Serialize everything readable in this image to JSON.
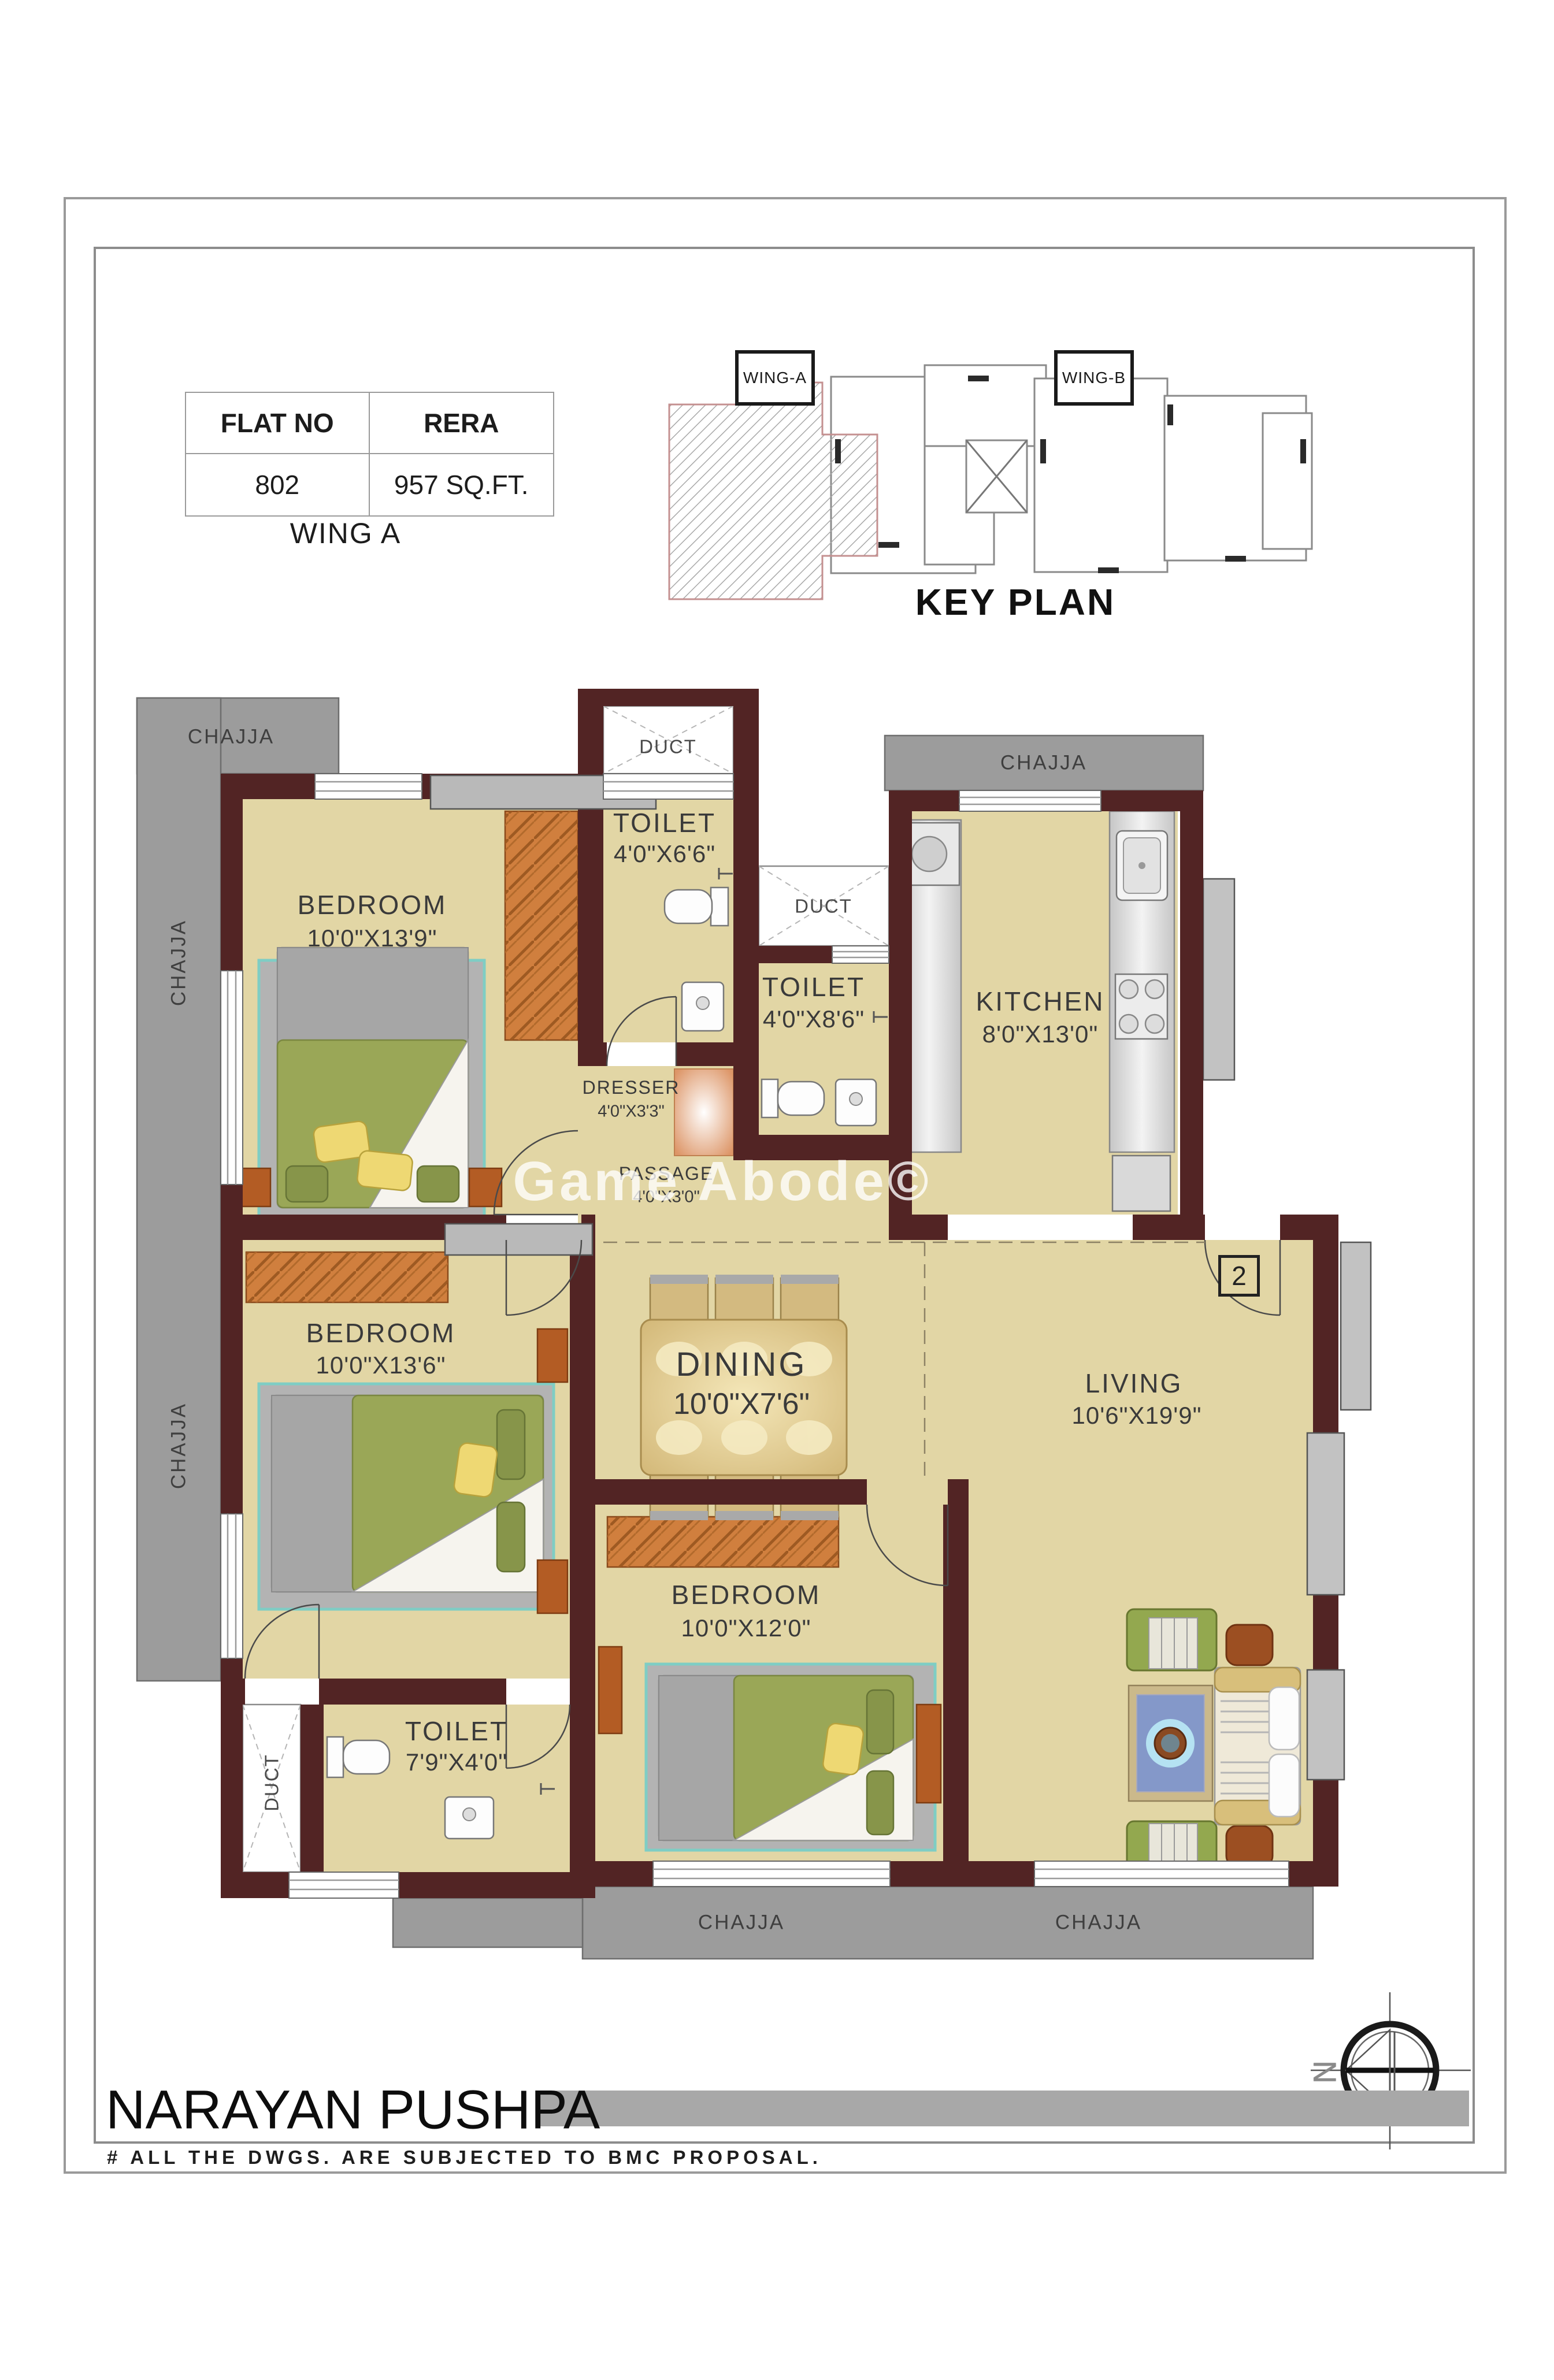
{
  "palette": {
    "wall": "#522424",
    "floor": "#e2d6a5",
    "chajja": "#9c9c9c",
    "wardrobe": "#d07f3e",
    "text": "#3a3a3a",
    "chajja_text": "#3f3f3f"
  },
  "flat_table": {
    "headers": [
      "FLAT NO",
      "RERA"
    ],
    "flat_no": "802",
    "rera_area": "957 SQ.FT.",
    "wing": "WING A"
  },
  "key_plan": {
    "title": "KEY PLAN",
    "wing_a": "WING-A",
    "wing_b": "WING-B"
  },
  "labels": {
    "chajja": "CHAJJA",
    "duct": "DUCT"
  },
  "rooms": {
    "bedroom1": {
      "name": "BEDROOM",
      "dims": "10'0\"X13'9\""
    },
    "bedroom2": {
      "name": "BEDROOM",
      "dims": "10'0\"X13'6\""
    },
    "bedroom3": {
      "name": "BEDROOM",
      "dims": "10'0\"X12'0\""
    },
    "kitchen": {
      "name": "KITCHEN",
      "dims": "8'0\"X13'0\""
    },
    "living": {
      "name": "LIVING",
      "dims": "10'6\"X19'9\""
    },
    "dining": {
      "name": "DINING",
      "dims": "10'0\"X7'6\""
    },
    "toilet1": {
      "name": "TOILET",
      "dims": "4'0\"X6'6\""
    },
    "toilet2": {
      "name": "TOILET",
      "dims": "4'0\"X8'6\""
    },
    "toilet3": {
      "name": "TOILET",
      "dims": "7'9\"X4'0\""
    },
    "dresser": {
      "name": "DRESSER",
      "dims": "4'0\"X3'3\""
    },
    "passage": {
      "name": "PASSAGE",
      "dims": "4'0\"X3'0\""
    }
  },
  "entrance": {
    "door_number": "2"
  },
  "compass": {
    "north": "N"
  },
  "watermark": "Game Abode©",
  "footer": {
    "project": "NARAYAN PUSHPA",
    "disclaimer": "# ALL THE DWGS. ARE SUBJECTED TO BMC PROPOSAL."
  }
}
